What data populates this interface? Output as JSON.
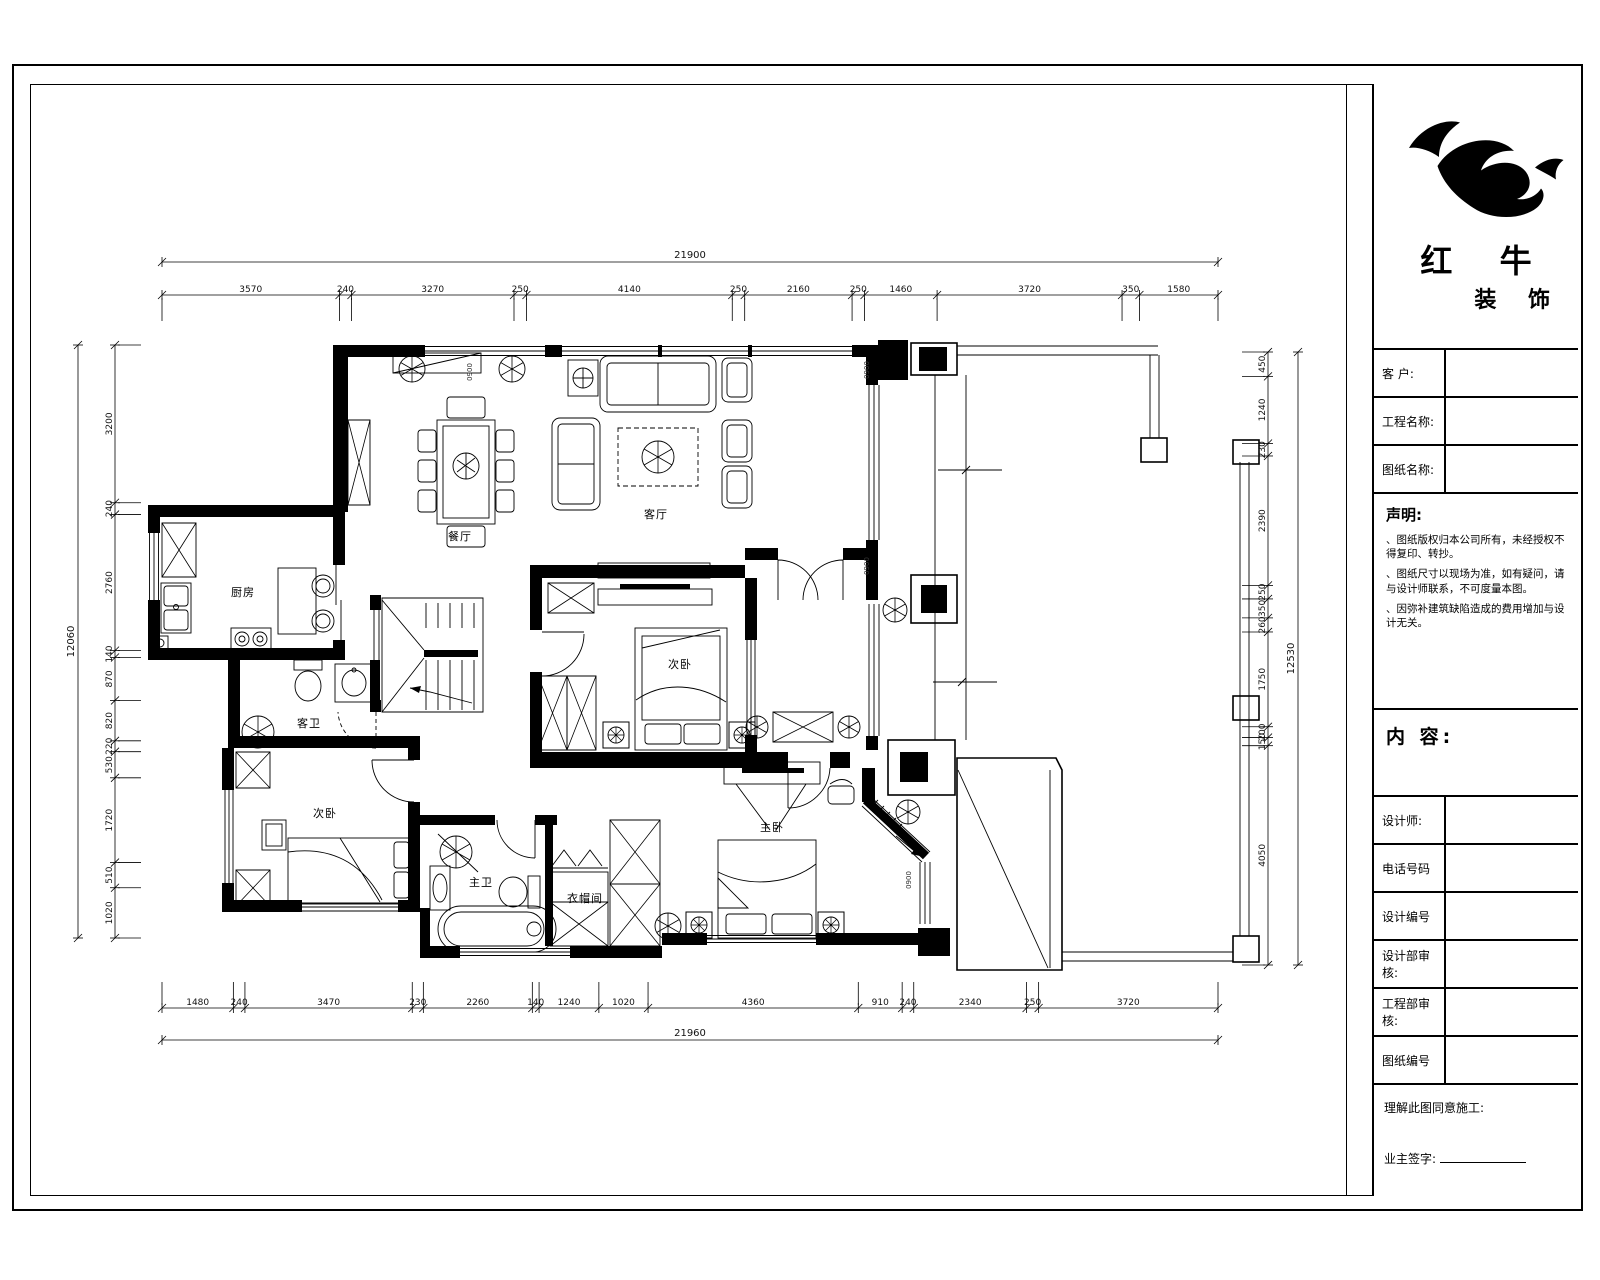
{
  "company": {
    "name_primary": "红 牛",
    "name_secondary": "装 饰"
  },
  "title_block": {
    "rows_top": [
      {
        "label": "客 户:"
      },
      {
        "label": "工程名称:"
      },
      {
        "label": "图纸名称:"
      }
    ],
    "statement": {
      "heading": "声明:",
      "notes": [
        "、图纸版权归本公司所有，未经授权不得复印、转抄。",
        "、图纸尺寸以现场为准，如有疑问，请与设计师联系，不可度量本图。",
        "、因弥补建筑缺陷造成的费用增加与设计无关。"
      ]
    },
    "content_heading": "内 容:",
    "rows_bottom": [
      {
        "label": "设计师:"
      },
      {
        "label": "电话号码"
      },
      {
        "label": "设计编号"
      },
      {
        "label": "设计部审核:"
      },
      {
        "label": "工程部审核:"
      },
      {
        "label": "图纸编号"
      }
    ],
    "footer": {
      "line1": "理解此图同意施工:",
      "line2": "业主签字:"
    }
  },
  "rooms": {
    "dining": "餐厅",
    "living": "客厅",
    "kitchen": "厨房",
    "guest_bath": "客卫",
    "bedroom_mid": "次卧",
    "bedroom_left": "次卧",
    "master": "主卧",
    "master_bath": "主卫",
    "closet": "衣帽间"
  },
  "annotations": {
    "door_code": "0900"
  },
  "dimensions": {
    "top": {
      "total": "21900",
      "segments": [
        "3570",
        "240",
        "3270",
        "250",
        "4140",
        "250",
        "2160",
        "250",
        "1460",
        "3720",
        "350",
        "1580"
      ]
    },
    "bottom": {
      "total": "21960",
      "segments": [
        "1480",
        "240",
        "3470",
        "230",
        "2260",
        "140",
        "1240",
        "1020",
        "4360",
        "910",
        "240",
        "2340",
        "250",
        "3720"
      ]
    },
    "left": {
      "total": "12060",
      "segments": [
        "3200",
        "240",
        "2760",
        "140",
        "870",
        "820",
        "220",
        "530",
        "1720",
        "510",
        "1020"
      ]
    },
    "right": {
      "total": "12530",
      "segments": [
        "450",
        "1240",
        "230",
        "2390",
        "250",
        "350",
        "260",
        "1750",
        "200",
        "150",
        "4050"
      ]
    }
  }
}
